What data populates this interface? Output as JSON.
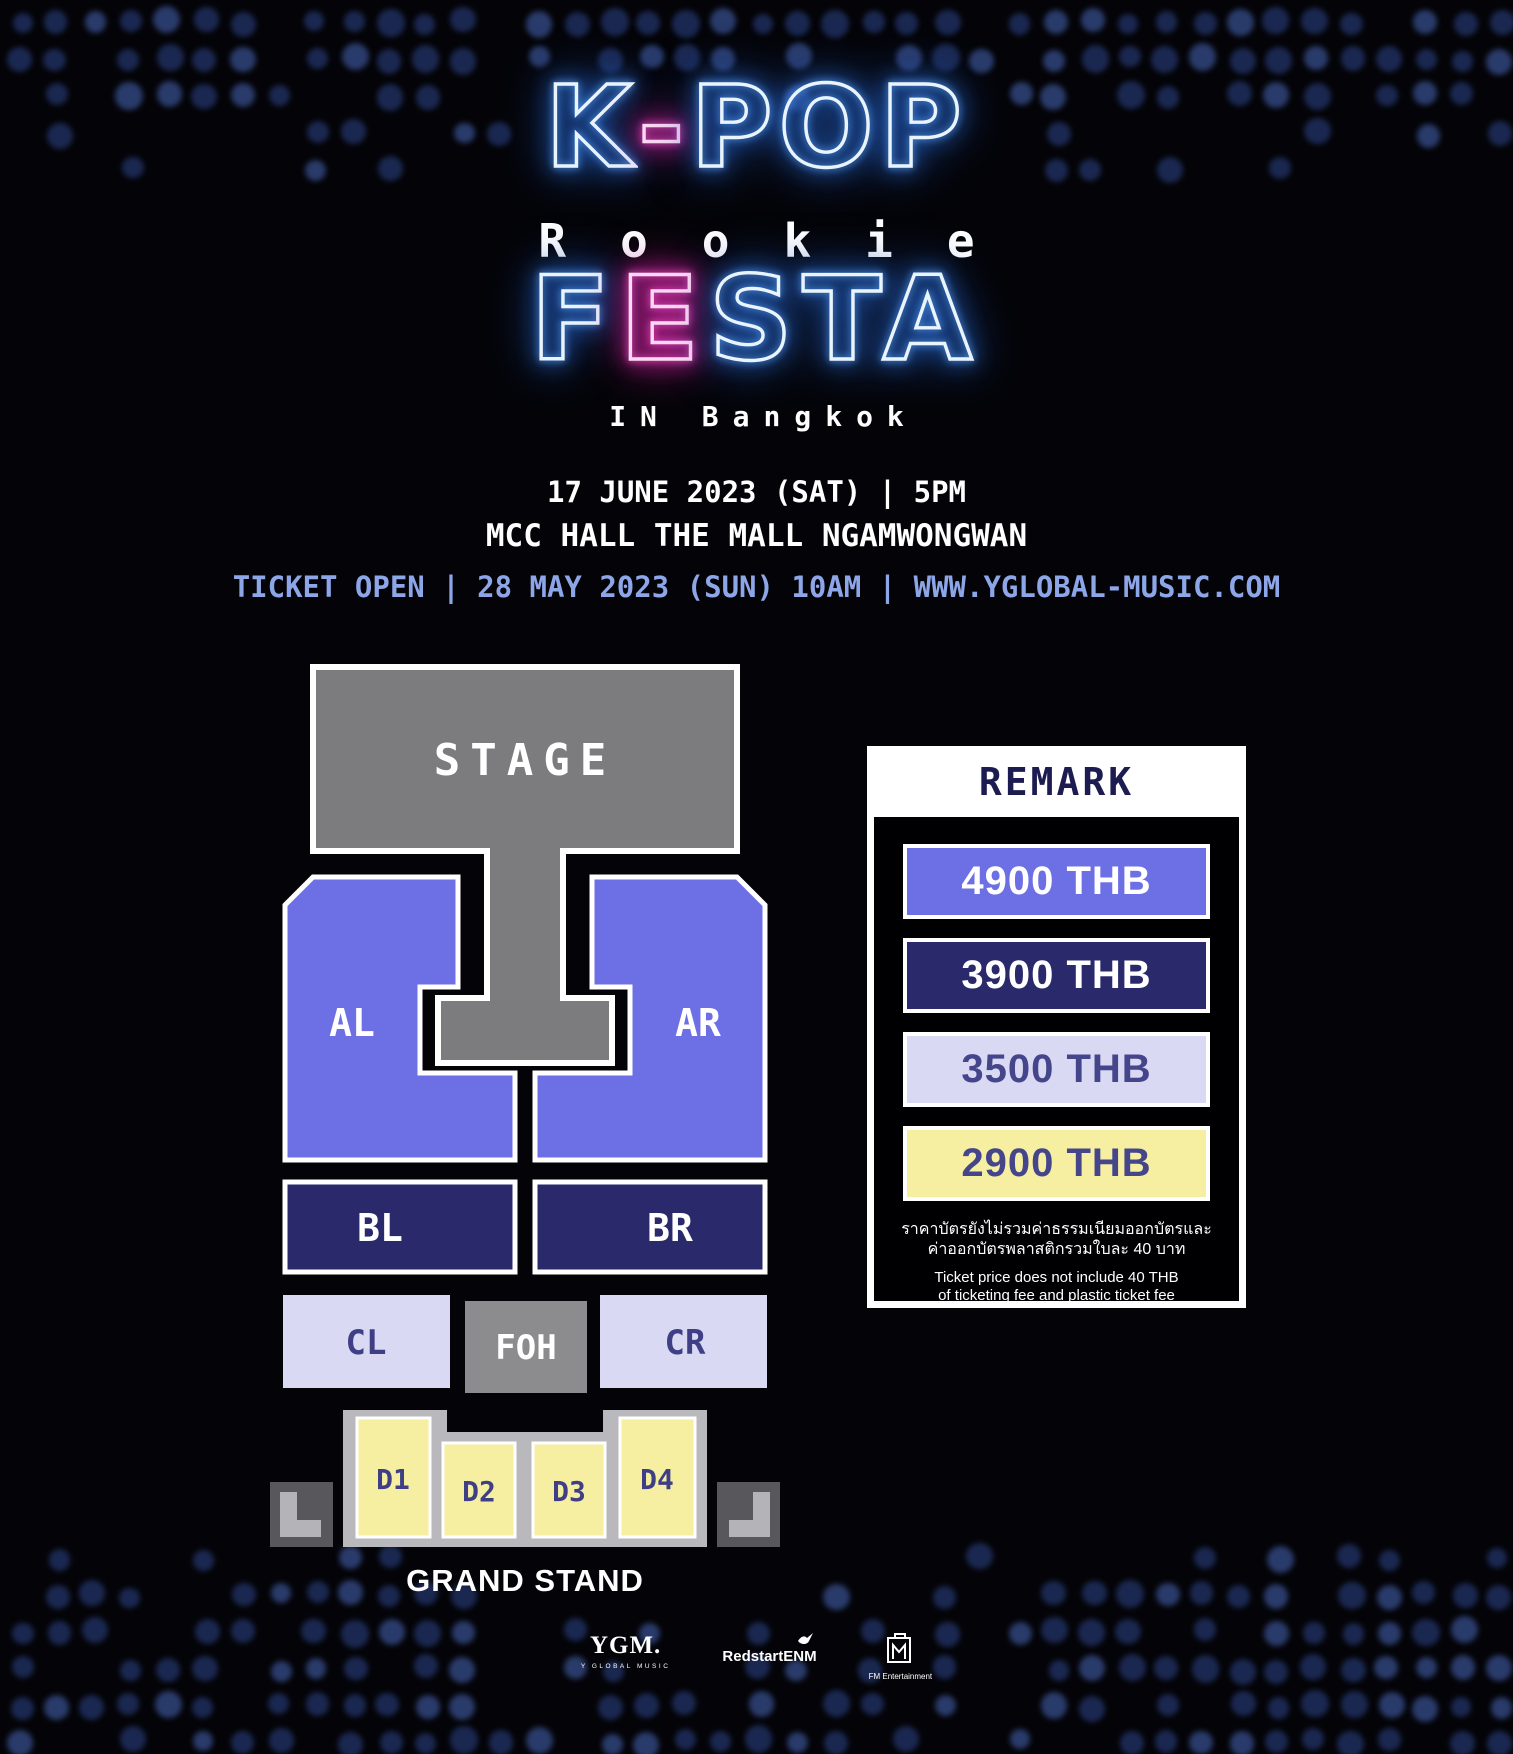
{
  "title": {
    "kpop_k": "K",
    "kpop_dash": "-",
    "kpop_pop": "POP",
    "rookie": "Rookie",
    "festa_f": "F",
    "festa_e": "E",
    "festa_sta": "STA",
    "location": "IN Bangkok"
  },
  "event": {
    "date": "17 JUNE 2023 (SAT)  |  5PM",
    "venue": "MCC HALL THE MALL NGAMWONGWAN",
    "ticket": "TICKET OPEN | 28 MAY 2023 (SUN) 10AM | WWW.YGLOBAL-MUSIC.COM"
  },
  "seat_map": {
    "stage": "STAGE",
    "al": "AL",
    "ar": "AR",
    "bl": "BL",
    "br": "BR",
    "cl": "CL",
    "foh": "FOH",
    "cr": "CR",
    "d1": "D1",
    "d2": "D2",
    "d3": "D3",
    "d4": "D4",
    "grand_stand": "GRAND STAND"
  },
  "remark": {
    "title": "REMARK",
    "prices": [
      {
        "label": "4900 THB",
        "bg": "#6d70e4",
        "fg": "#ffffff"
      },
      {
        "label": "3900 THB",
        "bg": "#29296b",
        "fg": "#ffffff"
      },
      {
        "label": "3500 THB",
        "bg": "#d9d9f4",
        "fg": "#45458c"
      },
      {
        "label": "2900 THB",
        "bg": "#f6efa2",
        "fg": "#45458c"
      }
    ],
    "note_th": [
      "ราคาบัตรยังไม่รวมค่าธรรมเนียมออกบัตรและ",
      "ค่าออกบัตรพลาสติกรวมใบละ 40 บาท"
    ],
    "note_en": [
      "Ticket price does not include 40 THB",
      "of ticketing fee and plastic ticket fee"
    ]
  },
  "footer": {
    "logo_ygm": "YGM.",
    "logo_ygm_sub": "Y GLOBAL MUSIC",
    "logo_redstart": "RedstartENM",
    "logo_fm": "FM Entertainment"
  },
  "colors": {
    "periwinkle": "#6d70e4",
    "navy": "#29296b",
    "lavender": "#d9d9f4",
    "yellow": "#f6efa2",
    "stage_gray": "#7c7c7f",
    "foh_gray": "#8c8c8f",
    "platform_gray": "#b9b9bd",
    "bracket_dark": "#57575c",
    "bracket_light": "#b4b4b8",
    "label_navy": "#3f3f85",
    "remark_navy": "#1c1c50",
    "ticket_blue": "#8ca6e8"
  }
}
